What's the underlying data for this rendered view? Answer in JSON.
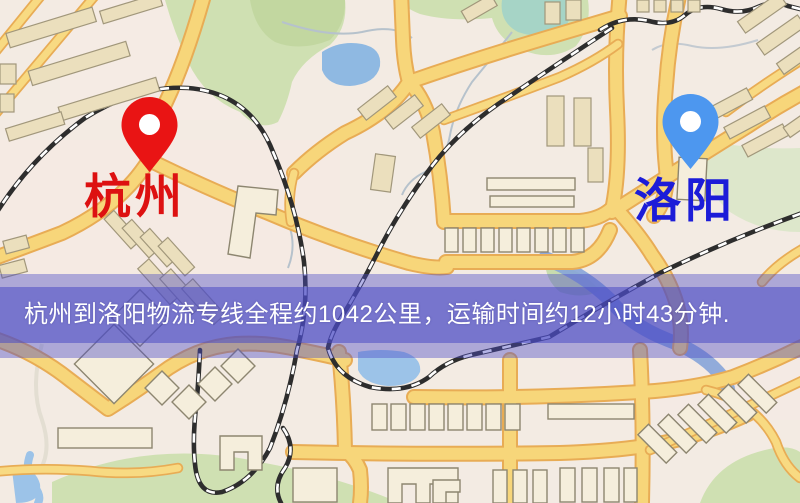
{
  "page": {
    "type": "logistics-route-map",
    "width_px": 800,
    "height_px": 503
  },
  "markers": [
    {
      "id": "origin",
      "label": "杭州",
      "pin_color": "#e91414",
      "label_color": "#dd1111",
      "icon": "map-pin-icon"
    },
    {
      "id": "destination",
      "label": "洛阳",
      "pin_color": "#4d97ef",
      "label_color": "#1c1cd8",
      "icon": "map-pin-icon"
    }
  ],
  "banner": {
    "text": "杭州到洛阳物流专线全程约1042公里，运输时间约12小时43分钟.",
    "text_color": "#ffffff",
    "overlay_color": "#4c4cc5",
    "route": {
      "origin": "杭州",
      "destination": "洛阳",
      "service": "物流专线",
      "distance_km": "1042",
      "duration": "12小时43分钟"
    }
  },
  "map_colors": {
    "background": "#f3ebe3",
    "road_fill": "#f7d67a",
    "road_casing": "#e8ac55",
    "park": "#cfe0b2",
    "pale_hill": "#dde7cb",
    "water": "#8fb9e2",
    "teal_pond": "#a6d4c6",
    "building": "#ebdfbd",
    "railway": "#2d2d2d"
  }
}
